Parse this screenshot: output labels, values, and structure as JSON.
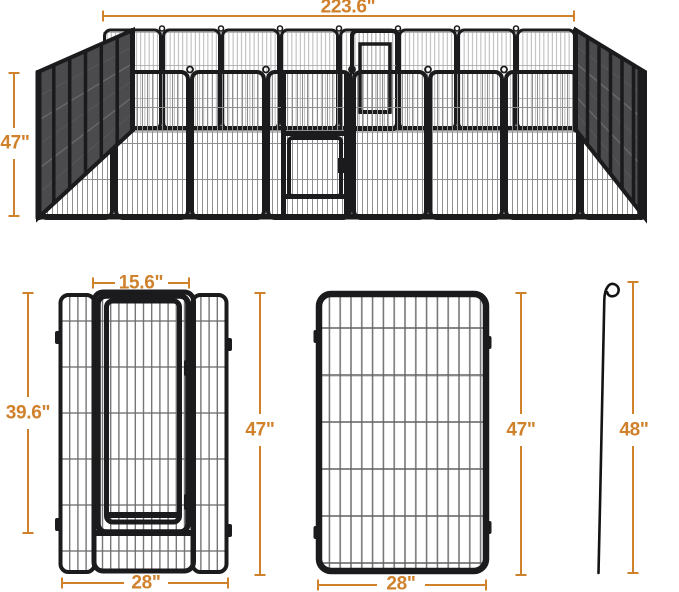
{
  "page": {
    "background": "#ffffff",
    "accent_color": "#D0812C",
    "frame_color": "#1b1b1d"
  },
  "figure": {
    "type": "product-dimension-diagram",
    "views": {
      "assembled_pen": "playpen-isometric-view",
      "gate_panel": "door-panel-front-view",
      "plain_panel": "panel-front-view",
      "stake": "ground-stake-view"
    }
  },
  "dims": {
    "pen_top_width": "223.6\"",
    "pen_side_height": "47\"",
    "gate_width": "15.6\"",
    "gate_height": "39.6\"",
    "door_panel_height": "47\"",
    "door_panel_width": "28\"",
    "panel_height": "47\"",
    "panel_width": "28\"",
    "stake_height": "48\""
  }
}
